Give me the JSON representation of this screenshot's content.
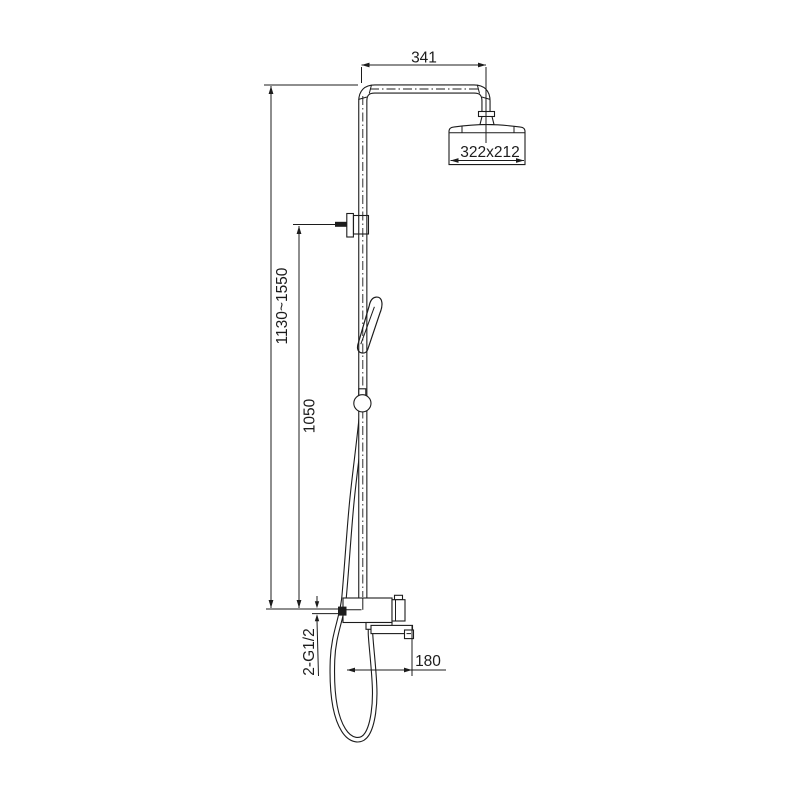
{
  "drawing": {
    "type": "technical-dimension-drawing",
    "subject": "shower column with overhead shower, hand shower on sliding rail, and wall mixer with bath spout",
    "background": "#ffffff",
    "line_color": "#1c1c1c",
    "dims": {
      "arm": "341",
      "head": "322x212",
      "height_range": "1130~1550",
      "slider": "1050",
      "inlet": "2-G1/2",
      "reach": "180"
    }
  }
}
